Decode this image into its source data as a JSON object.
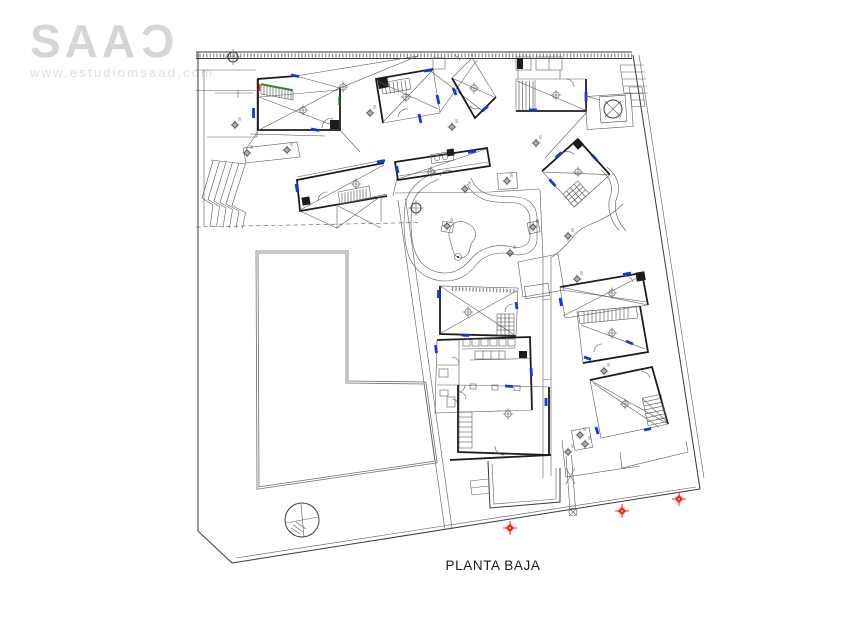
{
  "branding": {
    "logo_text": "SAA",
    "logo_last_letter": "Ɔ",
    "website": "www.estudiomsaad.com"
  },
  "drawing": {
    "caption": "PLANTA BAJA"
  },
  "colors": {
    "wall": "#1c1c1c",
    "line": "#3a3a3a",
    "thin": "#5a5a5a",
    "blue": "#1733e8",
    "green": "#1d8a1d",
    "red": "#ff2619",
    "logo": "#d6d6d6",
    "url_text": "#dedede",
    "plaza": "#707070",
    "caption": "#1b1b1b"
  },
  "symbols": {
    "tree": "circle-with-cross",
    "survey_marker": "red-diamond-cross",
    "benchmark": "flower-crosshair",
    "level_target": "circle-crosshair",
    "manhole": "circle-in-square"
  }
}
